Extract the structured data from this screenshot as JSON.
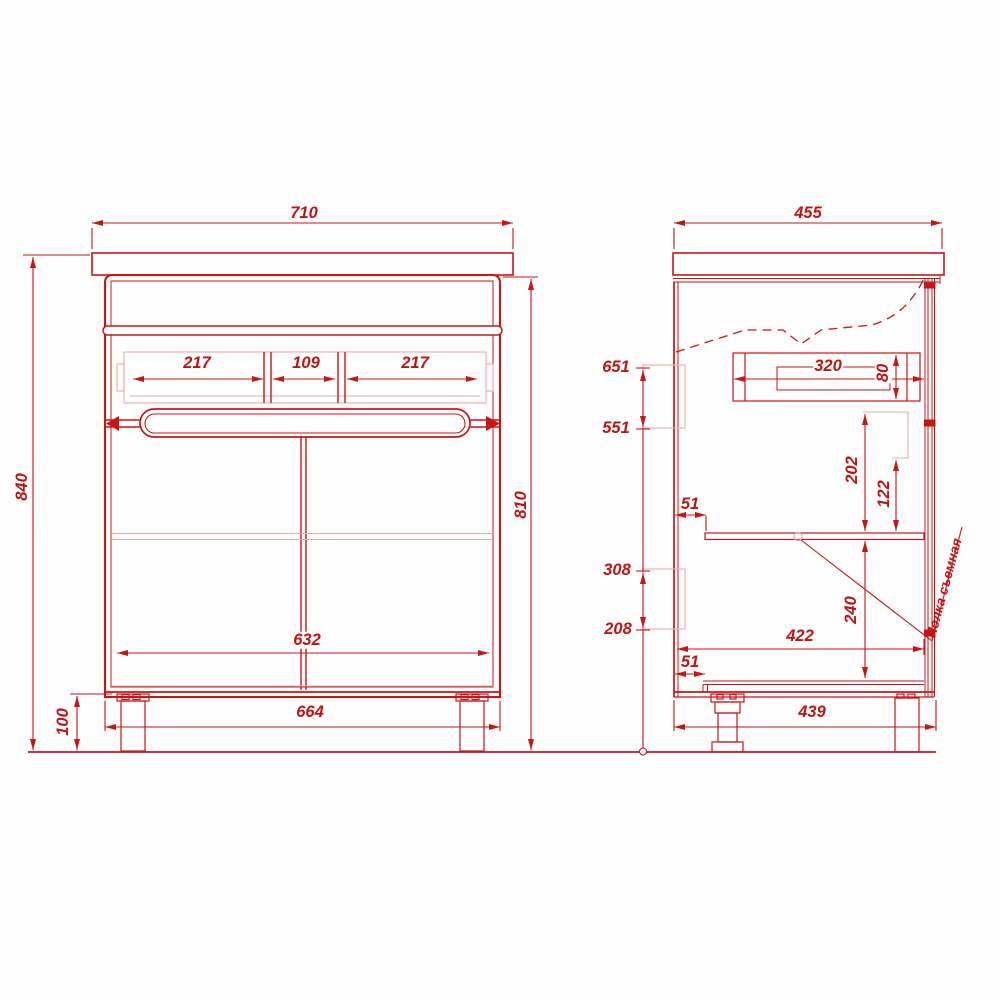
{
  "drawing_type": "cabinet dimension drawing",
  "front": {
    "w710": "710",
    "h840": "840",
    "h100": "100",
    "h810": "810",
    "d217a": "217",
    "d109": "109",
    "d217b": "217",
    "w632": "632",
    "w664": "664"
  },
  "side": {
    "w455": "455",
    "l651": "651",
    "l551": "551",
    "l308": "308",
    "l208": "208",
    "s51a": "51",
    "s51b": "51",
    "d320": "320",
    "d80": "80",
    "d202": "202",
    "d122": "122",
    "d240": "240",
    "w422": "422",
    "w439": "439",
    "note": "Полка съемная"
  },
  "colors": {
    "line": "#c81616",
    "light": "#f0a9a9",
    "text": "#c01414",
    "background": "#ffffff"
  }
}
